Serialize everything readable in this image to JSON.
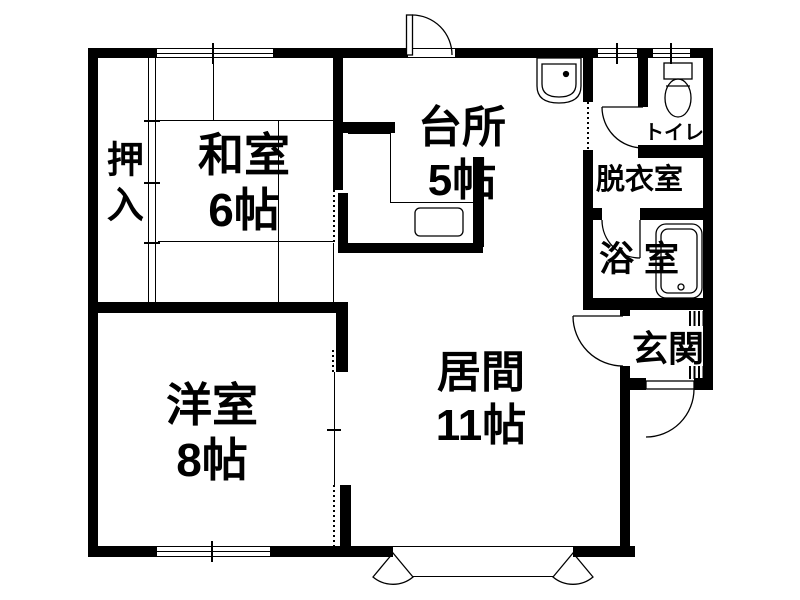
{
  "floorplan": {
    "rooms": {
      "oshiire": {
        "label": "押入"
      },
      "washitsu": {
        "label": "和室",
        "size": "6帖"
      },
      "kitchen": {
        "label": "台所",
        "size": "5帖"
      },
      "toilet": {
        "label": "トイレ"
      },
      "dressing": {
        "label": "脱衣室"
      },
      "bath": {
        "label": "浴室"
      },
      "entrance": {
        "label": "玄関"
      },
      "living": {
        "label": "居間",
        "size": "11帖"
      },
      "western": {
        "label": "洋室",
        "size": "8帖"
      }
    },
    "colors": {
      "wall": "#000000",
      "background": "#ffffff"
    }
  }
}
